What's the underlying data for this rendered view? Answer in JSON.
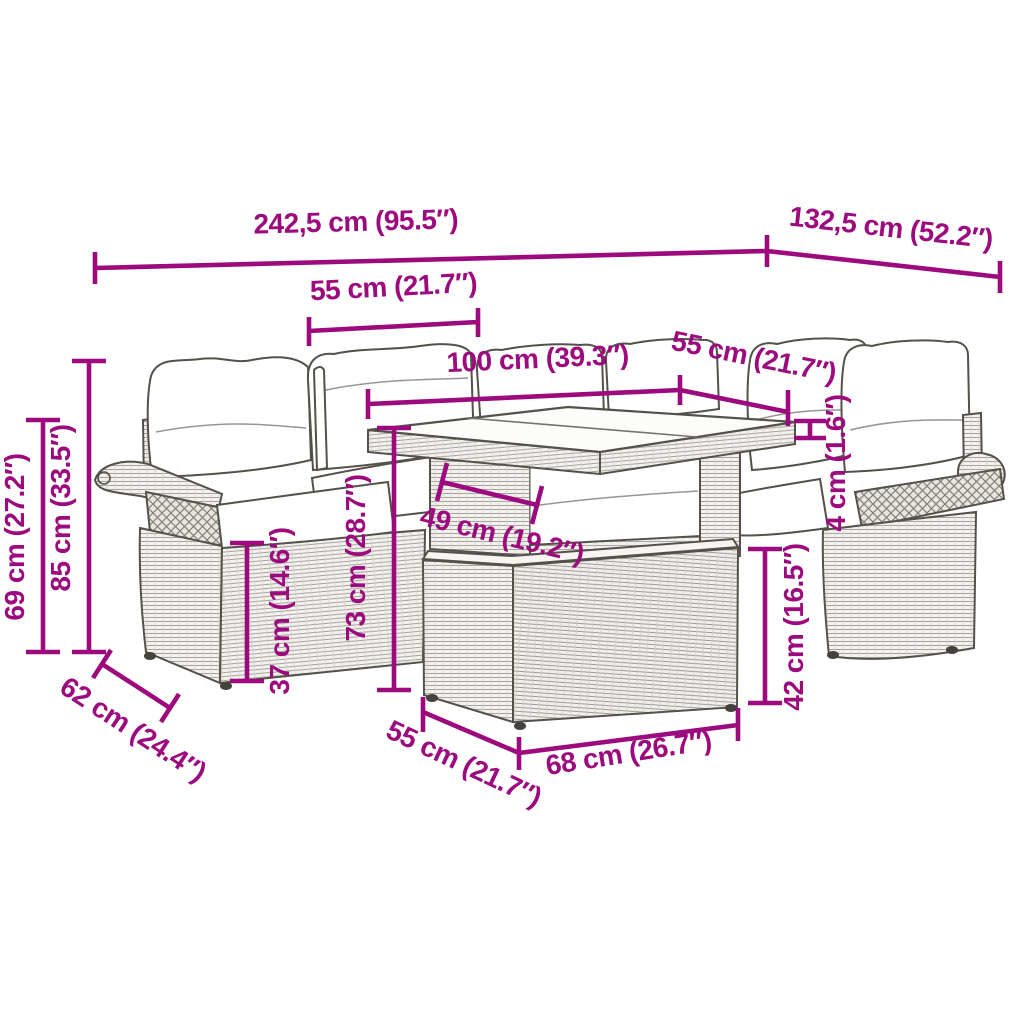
{
  "diagram": {
    "background": "#ffffff",
    "subject": "garden-lounge-set-dimension-drawing"
  },
  "colors": {
    "dimension_accent": "#9c0a7e",
    "artwork_line": "#54504a"
  },
  "dimensions": {
    "total_width": "242,5 cm (95.5″)",
    "total_depth": "132,5 cm (52.2″)",
    "left_seat_width": "55 cm (21.7″)",
    "table_length": "100 cm (39.3″)",
    "right_seat_width": "55 cm (21.7″)",
    "armrest_height": "69 cm (27.2″)",
    "back_height": "85 cm (33.5″)",
    "table_height": "73 cm (28.7″)",
    "seat_height": "37 cm (14.6″)",
    "tabletop_thickness": "4 cm (1.6″)",
    "ottoman_height": "42 cm (16.5″)",
    "seat_depth": "62 cm (24.4″)",
    "table_depth": "49 cm (19.2″)",
    "ottoman_depth": "55 cm (21.7″)",
    "ottoman_width": "68 cm (26.7″)"
  }
}
